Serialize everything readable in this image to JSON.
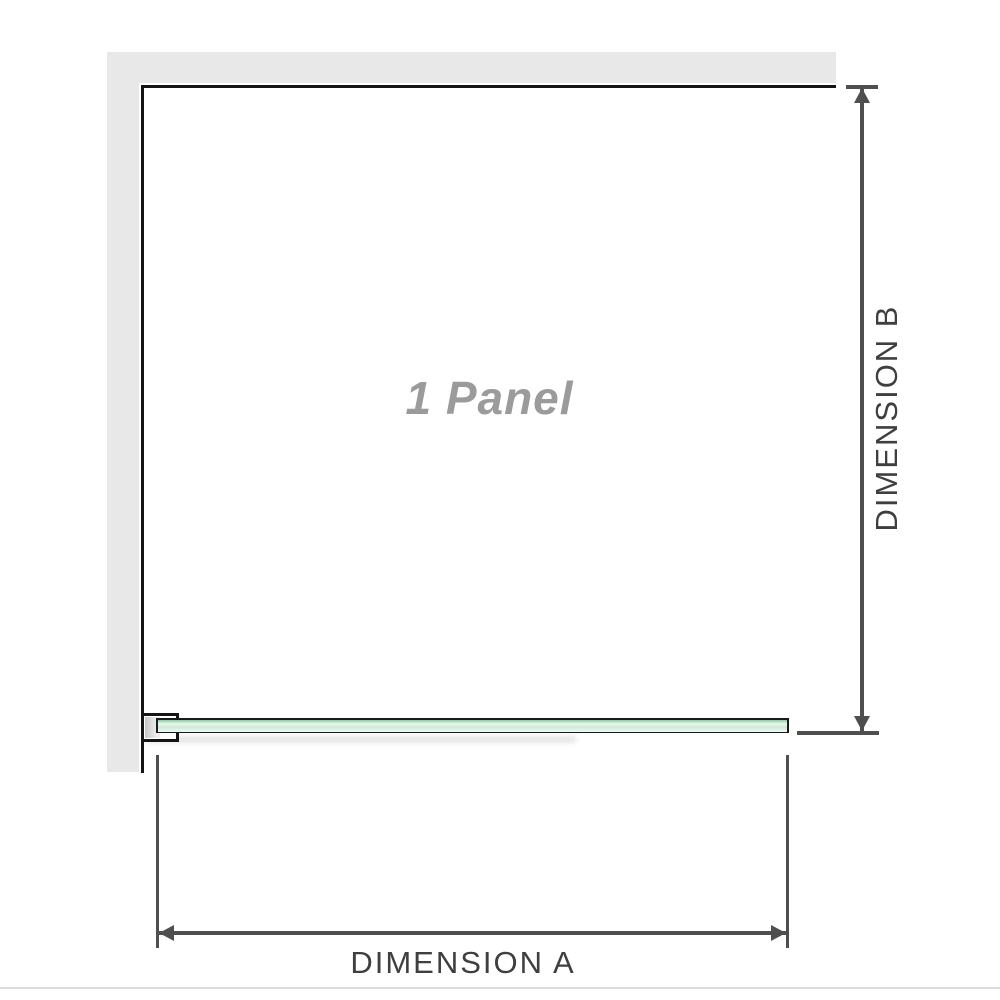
{
  "diagram": {
    "panel_label": "1 Panel",
    "dimensions": {
      "a_label": "DIMENSION A",
      "b_label": "DIMENSION B"
    },
    "colors": {
      "wall_gray": "#e8e8e8",
      "frame_black": "#141414",
      "dimension_line_gray": "#4f4f4f",
      "panel_label_gray": "#9b9b9b",
      "dimension_text_gray": "#3f3f3f",
      "glass_green": "#8cc7a0",
      "glass_green_light": "#ecf7f0",
      "bottom_rule_gray": "#dcdcdc"
    }
  }
}
